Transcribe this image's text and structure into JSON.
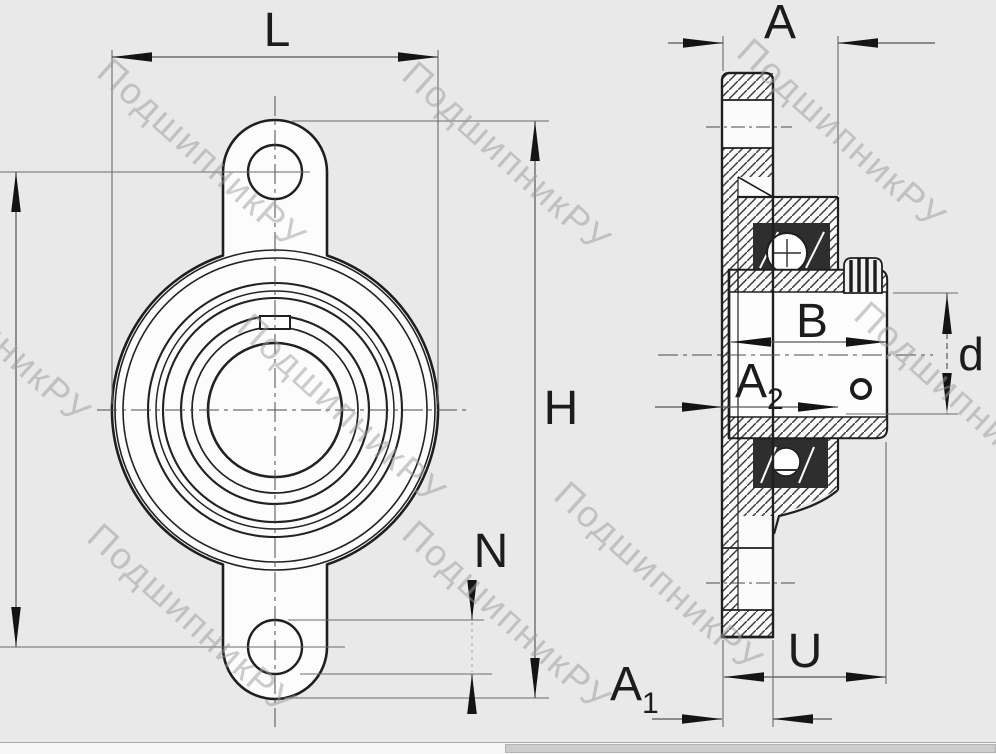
{
  "watermark": {
    "text": "ПодшипникРУ"
  },
  "dims": {
    "L": "L",
    "A": "A",
    "H": "H",
    "N": "N",
    "B": "B",
    "d": "d",
    "U": "U",
    "A1_main": "A",
    "A1_sub": "1",
    "A2_main": "A",
    "A2_sub": "2"
  },
  "colors": {
    "background": "#e9e9e9",
    "line": "#1f1f1f",
    "dimension": "#555555",
    "watermark": "#9b9b9b"
  }
}
